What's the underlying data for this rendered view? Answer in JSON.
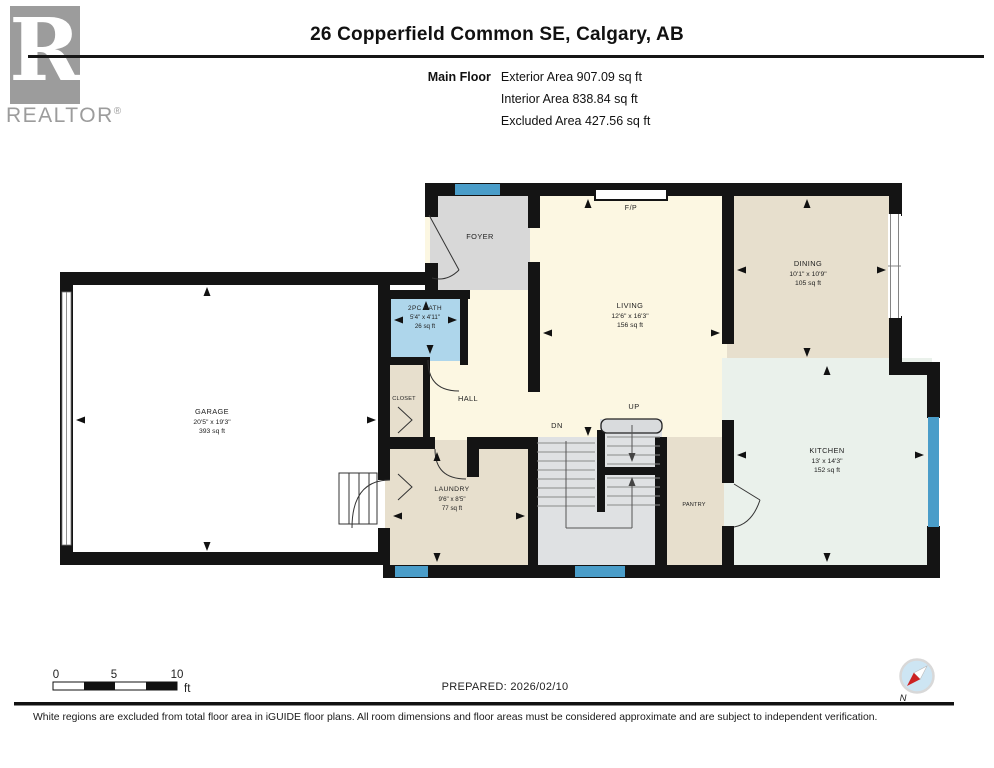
{
  "header": {
    "logo": {
      "monogram": "R",
      "brand": "REALTOR",
      "registered": "®"
    },
    "title": "26 Copperfield Common SE, Calgary, AB",
    "floor_label": "Main Floor",
    "area_lines": [
      "Exterior Area 907.09 sq ft",
      "Interior Area 838.84 sq ft",
      "Excluded Area 427.56 sq ft"
    ]
  },
  "plan": {
    "rooms": {
      "foyer": {
        "name": "FOYER"
      },
      "bath": {
        "name": "2PC BATH",
        "dims": "5'4\" x 4'11\"",
        "area": "26 sq ft"
      },
      "living": {
        "name": "LIVING",
        "dims": "12'6\" x 16'3\"",
        "area": "156 sq ft"
      },
      "dining": {
        "name": "DINING",
        "dims": "10'1\" x 10'9\"",
        "area": "105 sq ft"
      },
      "kitchen": {
        "name": "KITCHEN",
        "dims": "13' x 14'3\"",
        "area": "152 sq ft"
      },
      "garage": {
        "name": "GARAGE",
        "dims": "20'5\" x 19'3\"",
        "area": "393 sq ft"
      },
      "laundry": {
        "name": "LAUNDRY",
        "dims": "9'6\" x 8'5\"",
        "area": "77 sq ft"
      },
      "hall": {
        "name": "HALL"
      },
      "closet": {
        "name": "CLOSET"
      },
      "pantry": {
        "name": "PANTRY"
      }
    },
    "markers": {
      "fireplace": "F/P",
      "up": "UP",
      "down": "DN"
    }
  },
  "footer": {
    "scale": {
      "ticks": [
        "0",
        "5",
        "10"
      ],
      "unit": "ft"
    },
    "prepared_label": "PREPARED: 2026/02/10",
    "compass_north": "N",
    "disclaimer": "White regions are excluded from total floor area in iGUIDE floor plans. All room dimensions and floor areas must be considered approximate and are subject to independent verification."
  },
  "colors": {
    "wall": "#141414",
    "window_blue": "#4a9dc9",
    "bath_blue": "#aed6eb",
    "cream": "#fcf7e2",
    "tan": "#e7dfcd",
    "mint": "#eaf1eb",
    "foyer_gray": "#d8d8d8",
    "stair_gray": "#dfe1e3",
    "logo_gray": "#9c9c9c"
  }
}
